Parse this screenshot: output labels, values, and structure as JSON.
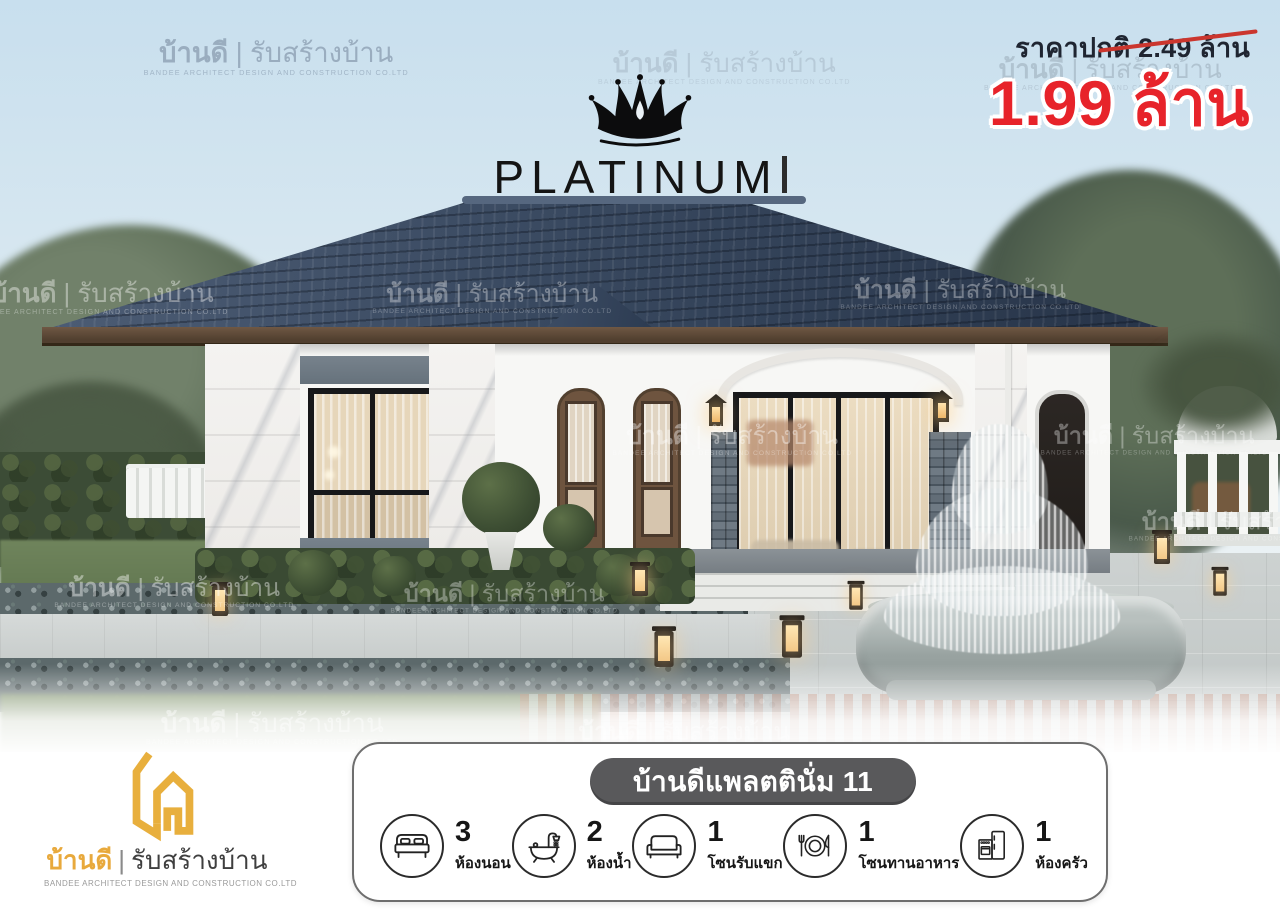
{
  "brand": {
    "name": "บ้านดี",
    "divider": "|",
    "tagline": "รับสร้างบ้าน",
    "company": "BANDEE ARCHITECT DESIGN AND CONSTRUCTION CO.LTD"
  },
  "series_badge": {
    "label": "PLATINUM"
  },
  "pricing": {
    "regular_label": "ราคาปกติ 2.49 ล้าน",
    "promo_price": "1.99 ล้าน",
    "promo_color": "#e7232a",
    "regular_color": "#1f2531"
  },
  "model_card": {
    "title": "บ้านดีแพลตตินั่ม 11",
    "features": [
      {
        "icon": "bed-icon",
        "count": "3",
        "label": "ห้องนอน"
      },
      {
        "icon": "bathtub-icon",
        "count": "2",
        "label": "ห้องน้ำ"
      },
      {
        "icon": "sofa-icon",
        "count": "1",
        "label": "โซนรับแขก"
      },
      {
        "icon": "dining-icon",
        "count": "1",
        "label": "โซนทานอาหาร"
      },
      {
        "icon": "kitchen-icon",
        "count": "1",
        "label": "ห้องครัว"
      }
    ]
  },
  "colors": {
    "accent_gold": "#e8a93c",
    "promo_red": "#e7232a",
    "price_navy": "#1f2531",
    "pill_gray": "#59595b",
    "roof_blue": "#394960"
  }
}
